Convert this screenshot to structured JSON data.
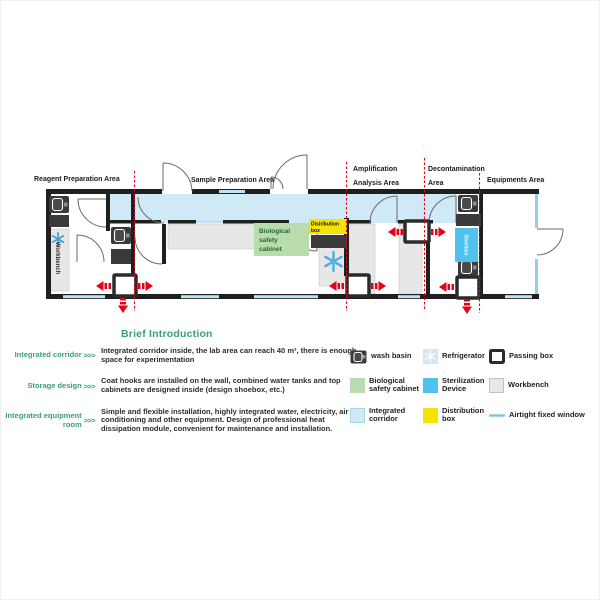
{
  "plan": {
    "areas": [
      {
        "lines": [
          "Reagent Preparation Area"
        ]
      },
      {
        "lines": [
          "Sample Preparation Area"
        ]
      },
      {
        "lines": [
          "Amplification",
          "Analysis Area"
        ]
      },
      {
        "lines": [
          "Decontamination",
          "Area"
        ]
      },
      {
        "lines": [
          "Equipments Area"
        ]
      }
    ],
    "fixtures": {
      "workbench": "Workbench",
      "bio": [
        "Biological",
        "safety",
        "cabinet"
      ],
      "dist": [
        "Distribution",
        "box"
      ],
      "sterilize": "Sterilize"
    }
  },
  "intro": {
    "title": "Brief Introduction",
    "arrows": ">>>",
    "rows": [
      {
        "label": "Integrated corridor",
        "text": "Integrated corridor inside, the lab area can reach 40 m², there is enough space for experimentation"
      },
      {
        "label": "Storage design",
        "text": "Coat hooks are installed on the wall, combined water tanks and top cabinets are designed inside (design shoebox, etc.)"
      },
      {
        "label": "Integrated equipment room",
        "text": "Simple and flexible installation, highly integrated water, electricity, air conditioning and other equipment. Design of professional heat dissipation module, convenient for maintenance and installation."
      }
    ]
  },
  "legend": {
    "items": [
      {
        "label": "wash basin",
        "icon": "wash-basin"
      },
      {
        "label": "Refrigerator",
        "icon": "refrigerator"
      },
      {
        "label": "Passing box",
        "icon": "passing-box"
      },
      {
        "label": "Biological safety cabinet",
        "icon": "biological-safety-cabinet"
      },
      {
        "label": "Sterilization Device",
        "icon": "sterilization-device"
      },
      {
        "label": "Workbench",
        "icon": "workbench"
      },
      {
        "label": "Integrated corridor",
        "icon": "integrated-corridor"
      },
      {
        "label": "Distribution box",
        "icon": "distribution-box"
      },
      {
        "label": "Airtight fixed window",
        "icon": "airtight-fixed-window"
      }
    ]
  },
  "colors": {
    "corridor": "#cfe9f7",
    "biological_cabinet": "#b9dcae",
    "biological_text": "#1e6b2e",
    "sterilization": "#4fc2ee",
    "distribution": "#f6e400",
    "workbench": "#e7e7e7",
    "wall": "#1f1f1f",
    "window_blue": "#bfe3f4",
    "flow_red": "#e60018",
    "teal": "#3a9c80",
    "snowflake_blue": "#3f9fdb"
  }
}
